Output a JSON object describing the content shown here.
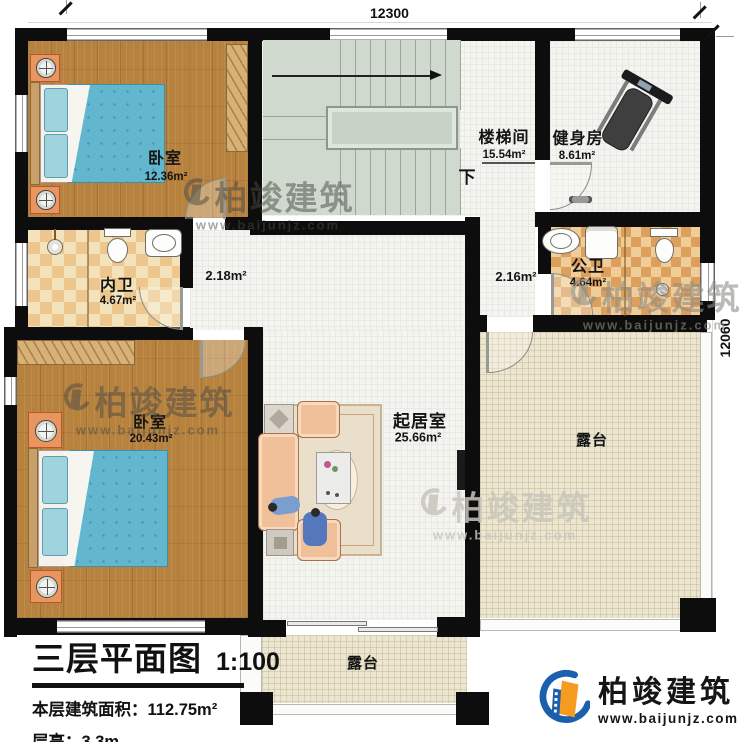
{
  "dimensions": {
    "top": "12300",
    "right": "12060"
  },
  "rooms": {
    "bedroom1": {
      "name": "卧室",
      "area": "12.36m²"
    },
    "stairwell": {
      "name": "楼梯间",
      "area": "15.54m²"
    },
    "gym": {
      "name": "健身房",
      "area": "8.61m²"
    },
    "inner_bath": {
      "name": "内卫",
      "area": "4.67m²"
    },
    "public_bath": {
      "name": "公卫",
      "area": "4.64m²"
    },
    "bedroom2": {
      "name": "卧室",
      "area": "20.43m²"
    },
    "living_room": {
      "name": "起居室",
      "area": "25.66m²"
    },
    "terrace_right": {
      "name": "露台"
    },
    "terrace_bottom": {
      "name": "露台"
    },
    "hall_left": {
      "area": "2.18m²"
    },
    "hall_right": {
      "area": "2.16m²"
    }
  },
  "stairs": {
    "down_label": "下"
  },
  "title_block": {
    "title": "三层平面图",
    "scale": "1:100",
    "area_label": "本层建筑面积：",
    "area_value": "112.75m²",
    "height_label": "层高：",
    "height_value": "3.3m"
  },
  "branding": {
    "company": "柏竣建筑",
    "website": "www.baijunjz.com",
    "blue": "#1b5fae",
    "orange": "#f59b20"
  },
  "colors": {
    "wall": "#0d0d0d",
    "wood_floor": "#b6823e",
    "stair_green": "#cfd9cd",
    "tile": "#f4f4f1",
    "inner_bath_tile": "#ecc68c",
    "public_bath_tile": "#dca05c",
    "terrace": "#ece6d0",
    "bed_blanket": "#62b6cd"
  }
}
